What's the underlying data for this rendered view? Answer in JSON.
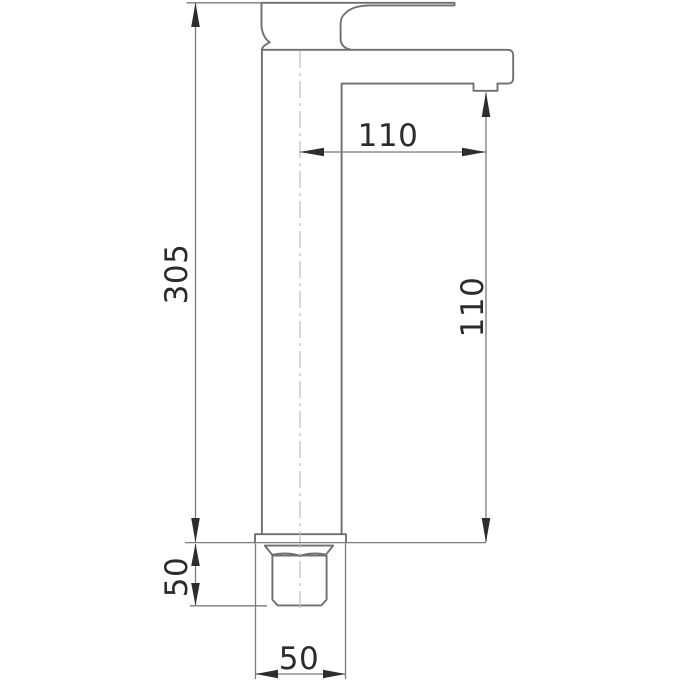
{
  "drawing": {
    "kind": "technical-dimension-drawing",
    "subject": "tall-basin-mixer-tap-side-view",
    "dimensions": {
      "total_height": {
        "value": "305",
        "orientation": "vertical"
      },
      "spout_reach": {
        "value": "110",
        "orientation": "horizontal"
      },
      "spout_height": {
        "value": "110",
        "orientation": "vertical"
      },
      "shank_length": {
        "value": "50",
        "orientation": "vertical"
      },
      "base_width": {
        "value": "50",
        "orientation": "horizontal"
      }
    },
    "colors": {
      "outline": "#6f6f6f",
      "dimension_line": "#7b7b7b",
      "arrow_and_text": "#2d2d2d",
      "centerline": "#bfbfbf",
      "background": "#ffffff"
    }
  }
}
